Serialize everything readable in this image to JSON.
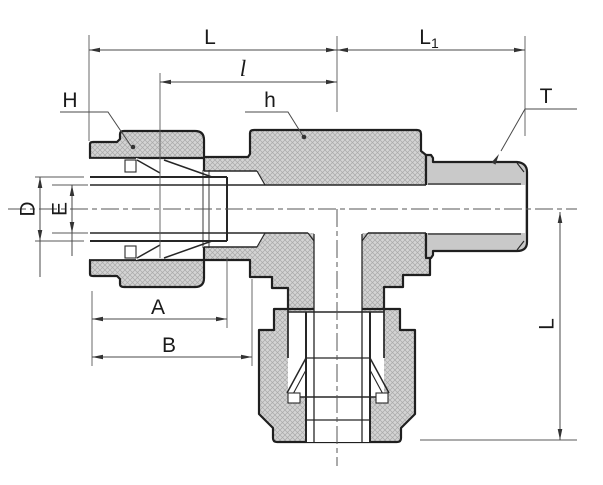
{
  "drawing": {
    "subject": "Tube fitting branch tee - sectional dimension drawing",
    "view": "cross-section with compression nuts, ferrules and male threaded end",
    "colors": {
      "background": "#ffffff",
      "outline": "#1f1f1f",
      "hatch_fill": "#d4d4d4",
      "hatch_line": "#a9a9a9",
      "thread_fill": "#c9c9c9",
      "dimension_line": "#4a4a4a",
      "text": "#1a1a1a"
    },
    "labels": {
      "L_top": "L",
      "L1_base": "L",
      "L1_sub": "1",
      "l_lower": "l",
      "H": "H",
      "h": "h",
      "T": "T",
      "D": "D",
      "E": "E",
      "A": "A",
      "B": "B",
      "L_right": "L"
    }
  }
}
